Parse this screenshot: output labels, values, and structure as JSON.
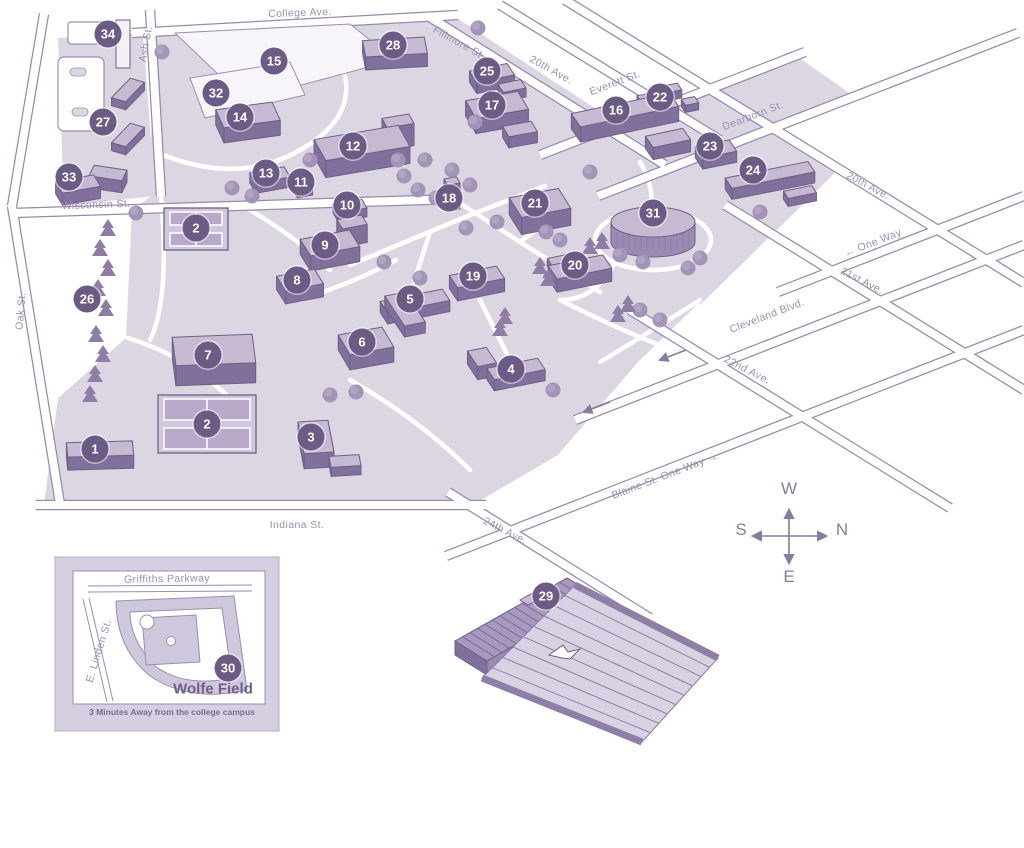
{
  "map": {
    "kind": "college campus map"
  },
  "colors": {
    "marker_bg": "#6b5b85",
    "marker_text": "#ffffff",
    "ground": "#dcd6e2",
    "building_side": "#9b8ab1",
    "building_top": "#c6bad3",
    "outline": "#6f5f87",
    "street_label": "#9a8fb2"
  },
  "streets": [
    {
      "id": "college-ave",
      "label": "College Ave.",
      "x": 300,
      "y": 13,
      "rot": -2
    },
    {
      "id": "ash-st",
      "label": "Ash St.",
      "x": 146,
      "y": 44,
      "rot": -80
    },
    {
      "id": "fillmore-st",
      "label": "Fillmore St.",
      "x": 459,
      "y": 43,
      "rot": 29
    },
    {
      "id": "20th-ave-top",
      "label": "20th Ave.",
      "x": 551,
      "y": 70,
      "rot": 29
    },
    {
      "id": "everett-st",
      "label": "Everett St.",
      "x": 615,
      "y": 83,
      "rot": -21
    },
    {
      "id": "dearborn-st",
      "label": "Dearborn St.",
      "x": 753,
      "y": 116,
      "rot": -21
    },
    {
      "id": "20th-ave-right",
      "label": "20th Ave.",
      "x": 868,
      "y": 186,
      "rot": 28
    },
    {
      "id": "one-way",
      "label": "← One Way",
      "x": 873,
      "y": 243,
      "rot": -21
    },
    {
      "id": "21st-ave",
      "label": "21st Ave.",
      "x": 862,
      "y": 281,
      "rot": 27
    },
    {
      "id": "wisconsin-st",
      "label": "Wisconsin St.",
      "x": 96,
      "y": 205,
      "rot": -2
    },
    {
      "id": "oak-st",
      "label": "Oak St.",
      "x": 21,
      "y": 311,
      "rot": -85
    },
    {
      "id": "cleveland-blvd",
      "label": "Cleveland Blvd.",
      "x": 767,
      "y": 316,
      "rot": -21
    },
    {
      "id": "22nd-ave",
      "label": "22nd Ave.",
      "x": 747,
      "y": 370,
      "rot": 27
    },
    {
      "id": "blaine-st",
      "label": "Blaine St. One Way →",
      "x": 665,
      "y": 476,
      "rot": -21
    },
    {
      "id": "24th-ave",
      "label": "24th Ave.",
      "x": 505,
      "y": 531,
      "rot": 27
    },
    {
      "id": "indiana-st",
      "label": "Indiana St.",
      "x": 297,
      "y": 525,
      "rot": 0
    }
  ],
  "markers": [
    {
      "n": "34",
      "x": 108,
      "y": 34
    },
    {
      "n": "28",
      "x": 393,
      "y": 45
    },
    {
      "n": "15",
      "x": 274,
      "y": 61
    },
    {
      "n": "25",
      "x": 487,
      "y": 71
    },
    {
      "n": "32",
      "x": 216,
      "y": 93
    },
    {
      "n": "22",
      "x": 660,
      "y": 97
    },
    {
      "n": "17",
      "x": 492,
      "y": 105
    },
    {
      "n": "16",
      "x": 616,
      "y": 110
    },
    {
      "n": "14",
      "x": 240,
      "y": 117
    },
    {
      "n": "27",
      "x": 103,
      "y": 122
    },
    {
      "n": "12",
      "x": 353,
      "y": 146
    },
    {
      "n": "23",
      "x": 710,
      "y": 146
    },
    {
      "n": "24",
      "x": 753,
      "y": 170
    },
    {
      "n": "33",
      "x": 69,
      "y": 177
    },
    {
      "n": "13",
      "x": 266,
      "y": 173
    },
    {
      "n": "11",
      "x": 301,
      "y": 182
    },
    {
      "n": "18",
      "x": 449,
      "y": 198
    },
    {
      "n": "10",
      "x": 347,
      "y": 205
    },
    {
      "n": "21",
      "x": 535,
      "y": 203
    },
    {
      "n": "31",
      "x": 653,
      "y": 213
    },
    {
      "n": "2",
      "x": 196,
      "y": 228
    },
    {
      "n": "9",
      "x": 325,
      "y": 245
    },
    {
      "n": "20",
      "x": 575,
      "y": 265
    },
    {
      "n": "19",
      "x": 473,
      "y": 276
    },
    {
      "n": "8",
      "x": 297,
      "y": 280
    },
    {
      "n": "26",
      "x": 87,
      "y": 299
    },
    {
      "n": "5",
      "x": 410,
      "y": 299
    },
    {
      "n": "6",
      "x": 362,
      "y": 342
    },
    {
      "n": "7",
      "x": 208,
      "y": 355
    },
    {
      "n": "4",
      "x": 511,
      "y": 369
    },
    {
      "n": "2",
      "x": 207,
      "y": 424
    },
    {
      "n": "1",
      "x": 95,
      "y": 449
    },
    {
      "n": "3",
      "x": 311,
      "y": 437
    },
    {
      "n": "29",
      "x": 546,
      "y": 596
    },
    {
      "n": "30",
      "x": 228,
      "y": 668
    }
  ],
  "compass": {
    "points": [
      {
        "label": "W",
        "x": 789,
        "y": 489
      },
      {
        "label": "S",
        "x": 741,
        "y": 530
      },
      {
        "label": "N",
        "x": 842,
        "y": 530
      },
      {
        "label": "E",
        "x": 789,
        "y": 577
      }
    ]
  },
  "inset": {
    "labels": [
      {
        "id": "griffiths-parkway",
        "label": "Griffiths Parkway",
        "x": 167,
        "y": 579,
        "rot": -1
      },
      {
        "id": "e-linden-st",
        "label": "E. Linden St.",
        "x": 99,
        "y": 651,
        "rot": -73
      }
    ],
    "field_name": "Wolfe Field",
    "note": "3 Minutes Away from the college campus"
  }
}
